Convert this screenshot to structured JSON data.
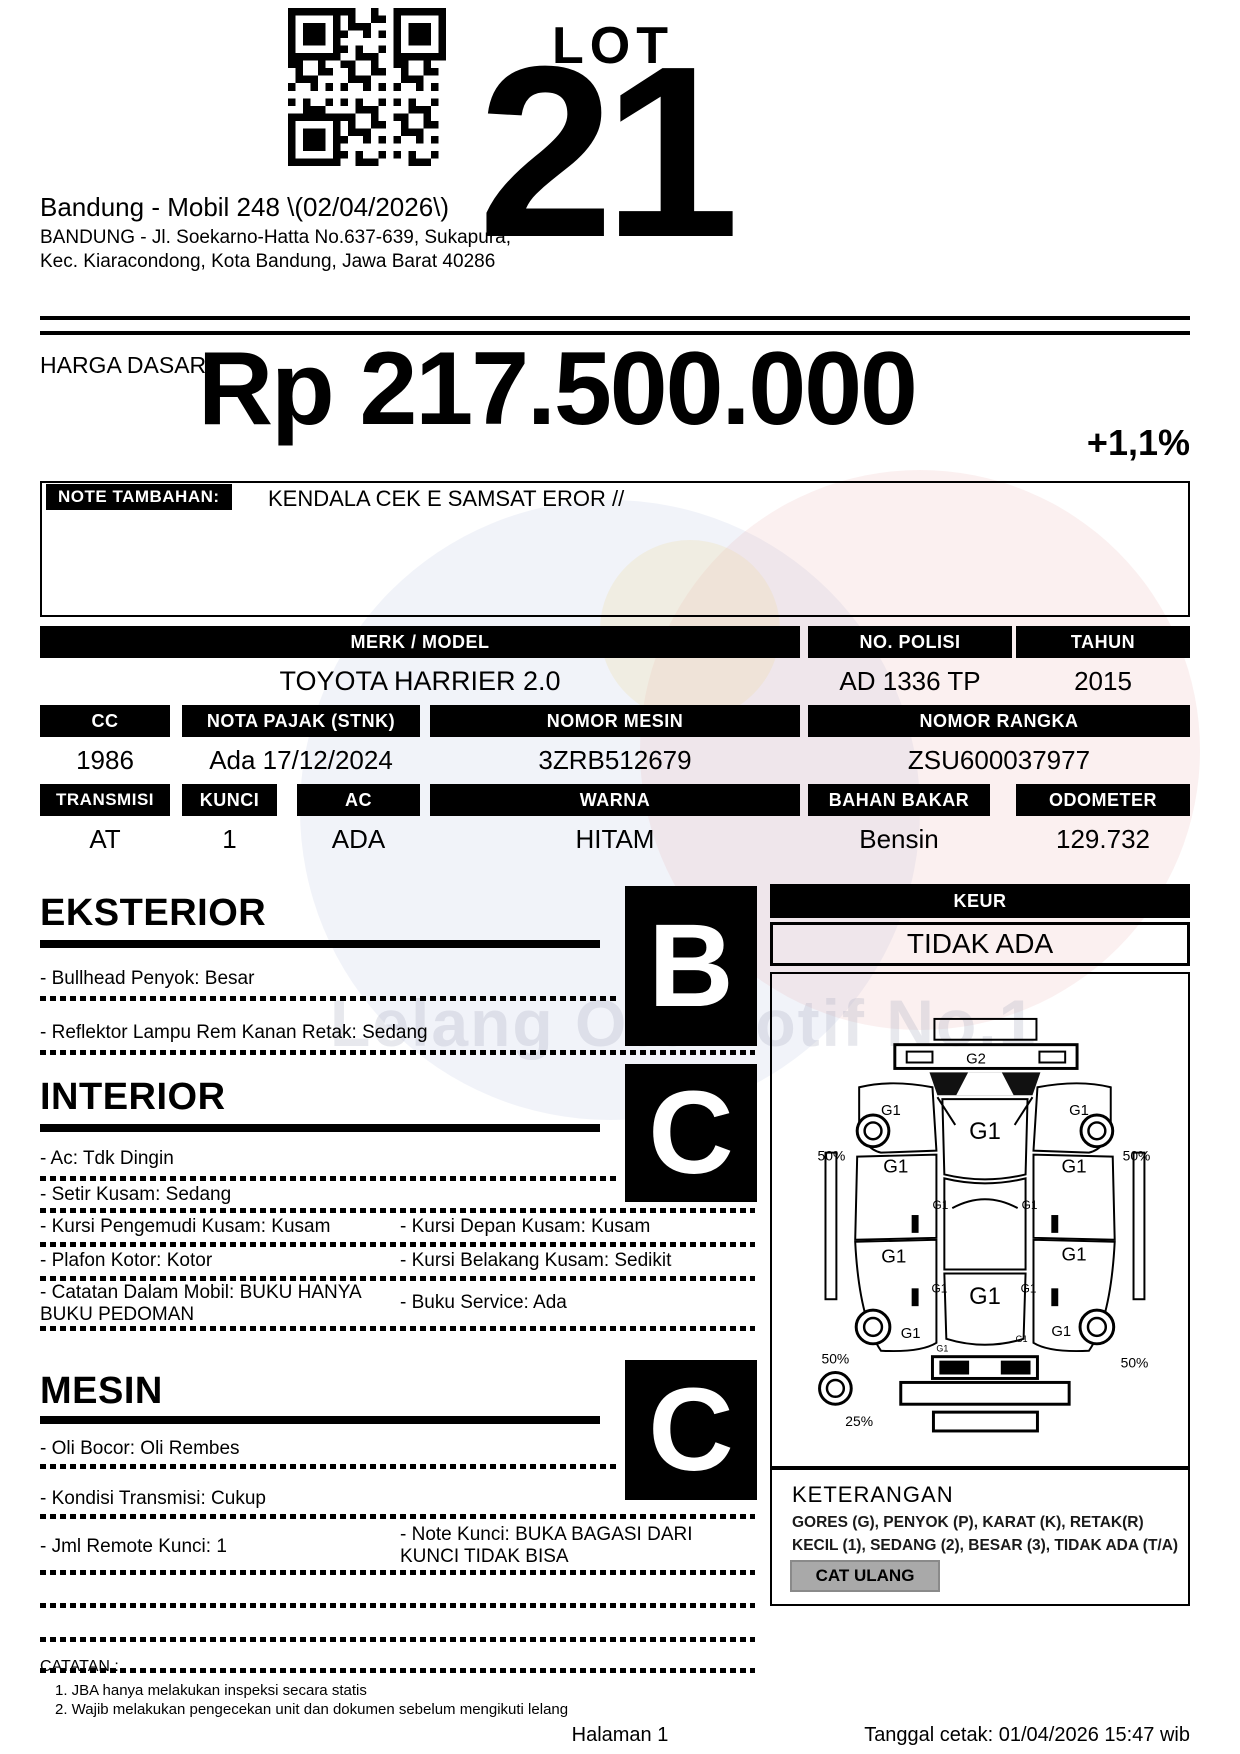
{
  "header": {
    "lot_label": "LOT",
    "lot_number": "21",
    "auction_title": "Bandung - Mobil 248 \\(02/04/2026\\)",
    "address_line1": "BANDUNG - Jl. Soekarno-Hatta No.637-639, Sukapura,",
    "address_line2": "Kec. Kiaracondong, Kota Bandung, Jawa Barat 40286"
  },
  "price": {
    "label": "HARGA DASAR :",
    "amount": "Rp 217.500.000",
    "change": "+1,1%"
  },
  "note": {
    "label": "NOTE TAMBAHAN:",
    "text": "KENDALA CEK E SAMSAT EROR //"
  },
  "specs": {
    "merk_model": {
      "label": "MERK / MODEL",
      "value": "TOYOTA HARRIER 2.0"
    },
    "no_polisi": {
      "label": "NO. POLISI",
      "value": "AD 1336 TP"
    },
    "tahun": {
      "label": "TAHUN",
      "value": "2015"
    },
    "cc": {
      "label": "CC",
      "value": "1986"
    },
    "nota_pajak": {
      "label": "NOTA PAJAK (STNK)",
      "value": "Ada 17/12/2024"
    },
    "nomor_mesin": {
      "label": "NOMOR MESIN",
      "value": "3ZRB512679"
    },
    "nomor_rangka": {
      "label": "NOMOR RANGKA",
      "value": "ZSU600037977"
    },
    "transmisi": {
      "label": "TRANSMISI",
      "value": "AT"
    },
    "kunci": {
      "label": "KUNCI",
      "value": "1"
    },
    "ac": {
      "label": "AC",
      "value": "ADA"
    },
    "warna": {
      "label": "WARNA",
      "value": "HITAM"
    },
    "bahan_bakar": {
      "label": "BAHAN BAKAR",
      "value": "Bensin"
    },
    "odometer": {
      "label": "ODOMETER",
      "value": "129.732"
    }
  },
  "sections": {
    "eksterior": {
      "title": "EKSTERIOR",
      "grade": "B",
      "items": [
        "- Bullhead Penyok: Besar",
        "- Reflektor Lampu Rem Kanan Retak: Sedang"
      ]
    },
    "interior": {
      "title": "INTERIOR",
      "grade": "C",
      "items": [
        "- Ac: Tdk Dingin",
        "- Setir Kusam: Sedang"
      ],
      "items_left": [
        "- Kursi Pengemudi Kusam: Kusam",
        "- Plafon Kotor: Kotor",
        "- Catatan Dalam Mobil: BUKU HANYA BUKU PEDOMAN"
      ],
      "items_right": [
        "- Kursi Depan Kusam: Kusam",
        "- Kursi Belakang Kusam: Sedikit",
        "- Buku Service: Ada"
      ]
    },
    "mesin": {
      "title": "MESIN",
      "grade": "C",
      "items": [
        "- Oli Bocor: Oli Rembes",
        "- Kondisi Transmisi: Cukup",
        "- Jml Remote Kunci: 1"
      ],
      "note_kunci": "- Note Kunci: BUKA BAGASI DARI KUNCI TIDAK BISA"
    }
  },
  "keur": {
    "label": "KEUR",
    "value": "TIDAK ADA"
  },
  "diagram": {
    "front_bumper": "G2",
    "panel": "G1",
    "panel_small": "G1",
    "front_left_wheel_pct": "50%",
    "front_right_wheel_pct": "50%",
    "rear_left_wheel_pct": "50%",
    "rear_right_wheel_pct": "50%",
    "spare_pct": "25%"
  },
  "keterangan": {
    "title": "KETERANGAN",
    "line1": "GORES (G), PENYOK (P), KARAT (K), RETAK(R)",
    "line2": "KECIL (1), SEDANG (2), BESAR (3), TIDAK ADA (T/A)",
    "button": "CAT ULANG"
  },
  "catatan": {
    "label": "CATATAN :",
    "items": [
      "1. JBA hanya melakukan inspeksi secara statis",
      "2. Wajib melakukan pengecekan unit dan dokumen sebelum mengikuti lelang"
    ]
  },
  "footer": {
    "page": "Halaman 1",
    "printed": "Tanggal cetak: 01/04/2026 15:47 wib"
  },
  "watermark": {
    "text": "Lelang Otomotif No.1"
  }
}
